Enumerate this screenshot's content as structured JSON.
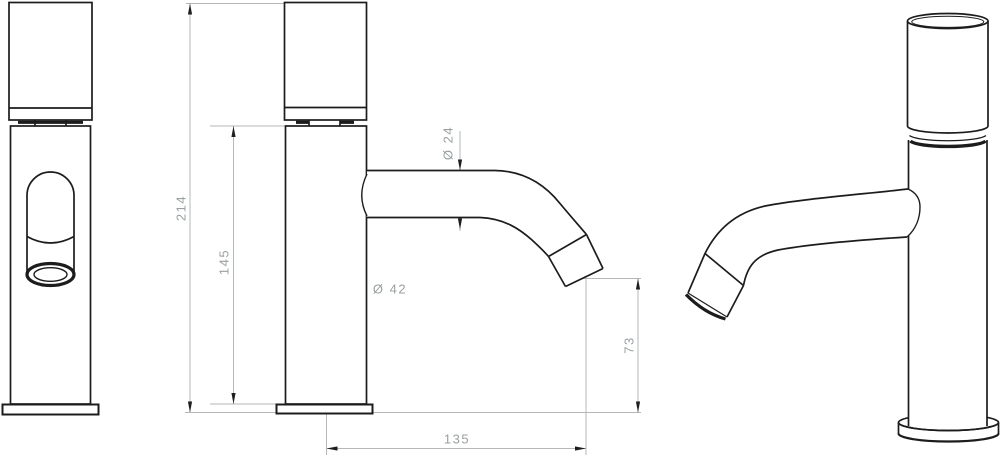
{
  "drawing": {
    "type": "technical-drawing",
    "subject": "single-lever basin faucet, three views",
    "dimensions": {
      "overall_height": "214",
      "body_height": "145",
      "body_diameter": "Ø 42",
      "spout_diameter": "Ø 24",
      "outlet_height": "73",
      "spout_reach": "135"
    },
    "colors": {
      "object_line": "#1c1c1c",
      "dimension_line": "#b3b7b9",
      "dimension_text": "#9aa0a2",
      "arrow": "#1f1f1f",
      "background": "#ffffff"
    }
  }
}
